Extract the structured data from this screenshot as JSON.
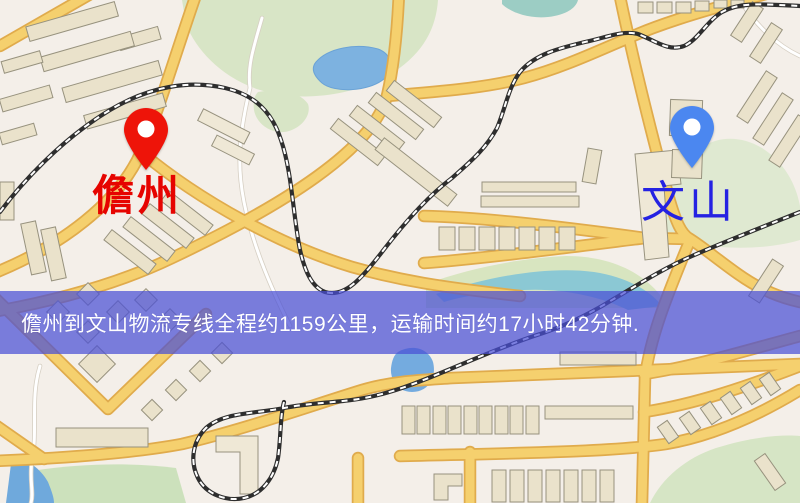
{
  "map": {
    "markers": [
      {
        "id": "origin",
        "label": "儋州",
        "label_color": "#e60400",
        "pin_color": "#ee1409",
        "pin_icon": "red-pin"
      },
      {
        "id": "destination",
        "label": "文山",
        "label_color": "#2522e2",
        "pin_color": "#4b87f0",
        "pin_icon": "blue-pin"
      }
    ],
    "banner": {
      "text": "儋州到文山物流专线全程约1159公里，运输时间约17小时42分钟.",
      "bg_color": "#494fd6",
      "text_color": "#ffffff"
    },
    "style_colors": {
      "road": "#f5d06e",
      "road_casing": "#e0ab4c",
      "water": "#7db2e0",
      "park": "#d8e5c6",
      "railway": "#2e2e2e",
      "background": "#f4efe9",
      "building": "#eae2cb"
    }
  }
}
